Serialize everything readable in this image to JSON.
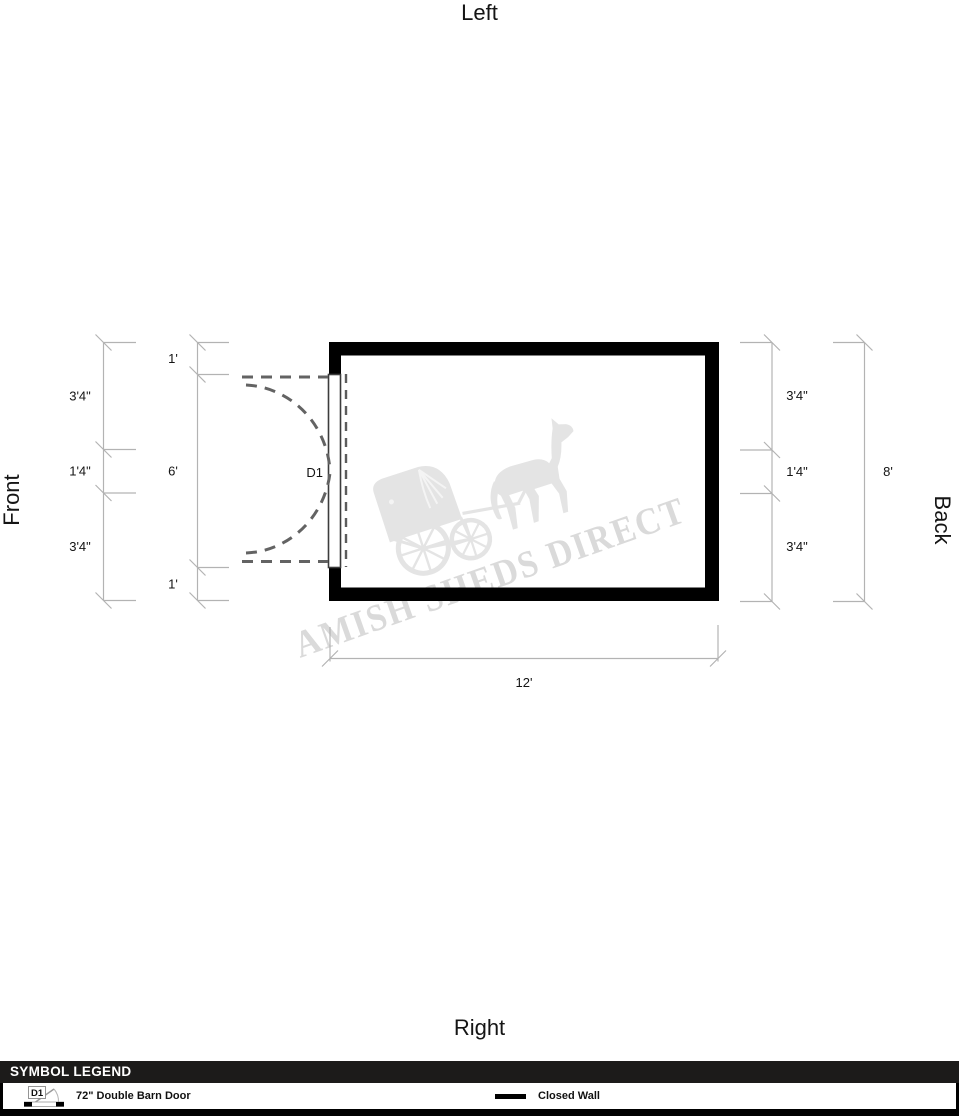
{
  "orientation_labels": {
    "top": "Left",
    "bottom": "Right",
    "left": "Front",
    "right": "Back"
  },
  "plan": {
    "door_label": "D1",
    "dimensions": {
      "left_outer": [
        "3'4\"",
        "1'4\"",
        "3'4\""
      ],
      "left_inner": [
        "1'",
        "6'",
        "1'"
      ],
      "right_inner": [
        "3'4\"",
        "1'4\"",
        "3'4\""
      ],
      "right_outer": "8'",
      "bottom": "12'"
    },
    "colors": {
      "wall": "#000000",
      "dimension_lines": "#b3b3b3",
      "door_dashes": "#636363",
      "watermark_text": "#dadada",
      "watermark_image": "#e4e4e4",
      "legend_header_bg": "#1c1b1a"
    }
  },
  "watermark": {
    "text": "AMISH SHEDS DIRECT"
  },
  "legend": {
    "title": "SYMBOL LEGEND",
    "items": [
      {
        "symbol": "double-barn-door",
        "symbol_label": "D1",
        "label": "72\" Double Barn Door"
      },
      {
        "symbol": "closed-wall",
        "label": "Closed Wall"
      }
    ]
  }
}
